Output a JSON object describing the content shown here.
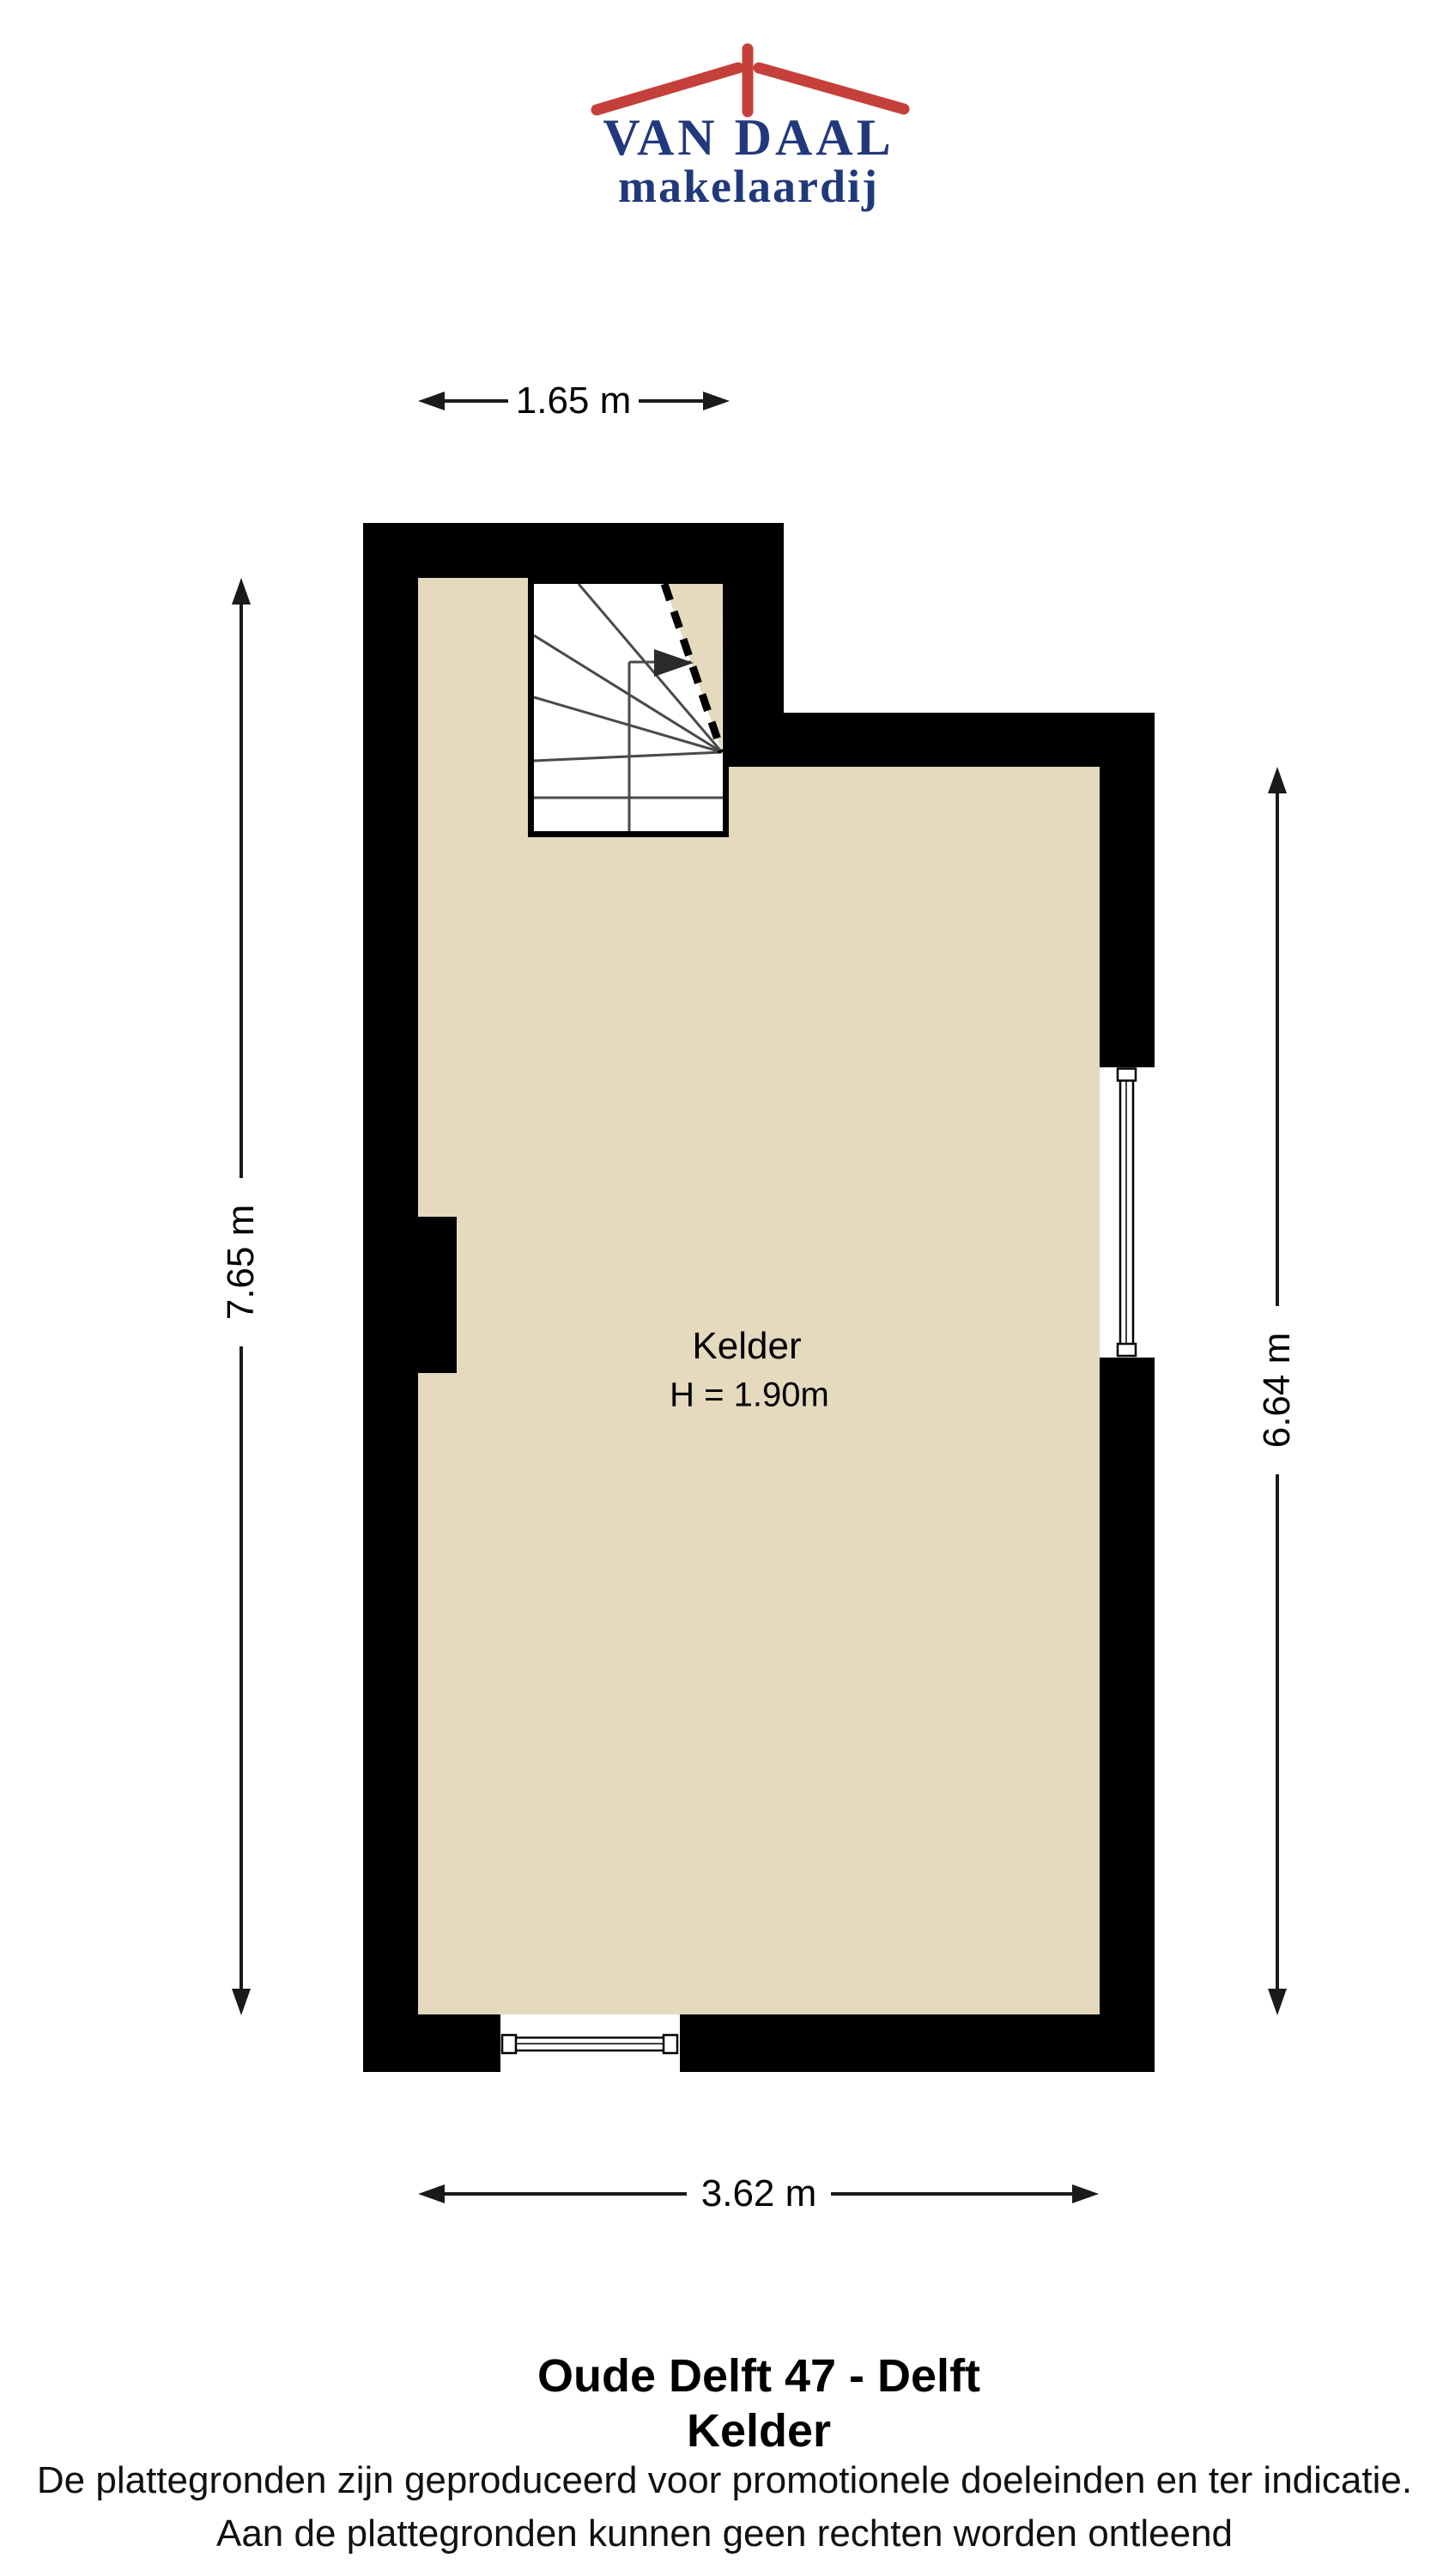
{
  "logo": {
    "brand": "VAN DAAL",
    "tagline": "makelaardij",
    "roof_color": "#c5403a",
    "text_color": "#21397c"
  },
  "colors": {
    "wall": "#000000",
    "floor": "#e5d9be",
    "dimension_line": "#1a1a1a",
    "stair_line": "#4a4a4a"
  },
  "dimensions": {
    "top": "1.65 m",
    "left": "7.65 m",
    "right": "6.64 m",
    "bottom": "3.62 m"
  },
  "room": {
    "name": "Kelder",
    "ceiling_height": "H = 1.90m"
  },
  "footer": {
    "title": "Oude Delft 47 - Delft",
    "subtitle": "Kelder",
    "disclaimer_line1": "De plattegronden zijn geproduceerd voor promotionele doeleinden en ter indicatie.",
    "disclaimer_line2": "Aan de plattegronden kunnen geen rechten worden ontleend"
  }
}
